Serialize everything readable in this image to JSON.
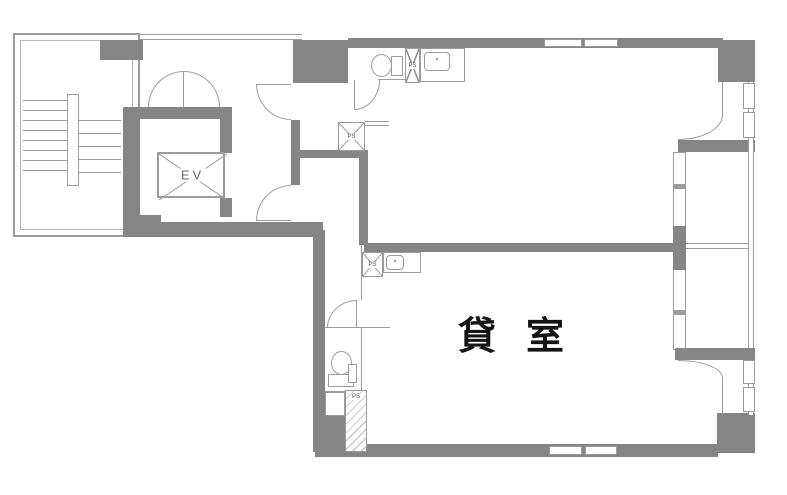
{
  "plan": {
    "room_label": "貸室",
    "elevator_label": "EV",
    "pipe_shaft_labels": {
      "upper_toilet": "PS",
      "corridor": "PS",
      "lower_room": "PS",
      "bottom": "PS"
    }
  },
  "colors": {
    "background": "#ffffff",
    "wall": "#858585",
    "line": "#9c9c9c",
    "line2": "#b8b8b8",
    "text": "#141414"
  }
}
